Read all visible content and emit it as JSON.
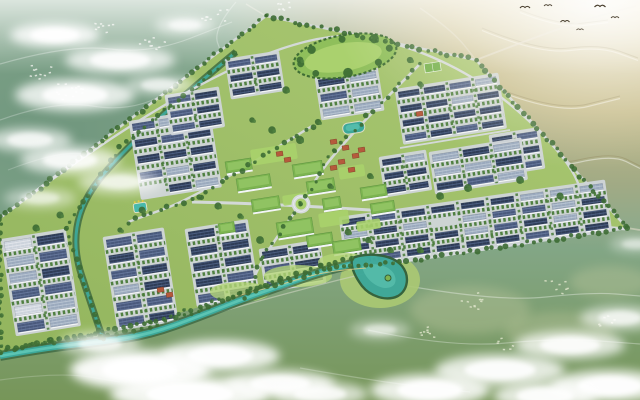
{
  "scene": {
    "canvas": {
      "w": 640,
      "h": 400
    },
    "palette": {
      "base": "#85a98e",
      "tealDeep": "#5f8770",
      "olive": "#74924f",
      "golden1": "#f2ecdb",
      "golden2": "#cdbf8e",
      "golden3": "#b7ab7d",
      "parkA": "#93b55e",
      "parkB": "#abc973",
      "lawn": "#a9d16c",
      "treeDark": "#3c6b33",
      "treeMid": "#4f8040",
      "road": "#d6dadd",
      "apron": "#d0d5d9",
      "wall": "#f4f6f8",
      "roofDark": "#2e3c56",
      "roofDarkLine": "#55698f",
      "roofMid": "#49597c",
      "roofMidLine": "#6e81a5",
      "roofLight": "#9aa9bd",
      "roofLightLine": "#c3cdd9",
      "roofPale": "#ccd3dc",
      "roofPaleLine": "#e9ecf1",
      "civicRoof": "#7cb450",
      "civicRoofIn": "#95c766",
      "civicEdge": "#5d9440",
      "villa": "#b55a3c",
      "villaEdge": "#7e3b24",
      "water": "#3da89a",
      "waterLight": "#62c9b7",
      "bank": "#33603c",
      "cloud": "#ffffff",
      "bird": "#473d2c",
      "village": "#e9ece6",
      "villageOlive": "#dde3c9",
      "ridge": "#8e8157",
      "pathGold": "#e6cf8a",
      "field": "#6fae46"
    },
    "park": {
      "boundary": [
        [
          0,
          218
        ],
        [
          266,
          16
        ],
        [
          476,
          60
        ],
        [
          627,
          228
        ],
        [
          400,
          262
        ],
        [
          330,
          268
        ],
        [
          248,
          292
        ],
        [
          150,
          322
        ],
        [
          60,
          340
        ],
        [
          0,
          352
        ]
      ]
    },
    "clusters": [
      {
        "name": "west-grid-a",
        "x": 4,
        "y": 242,
        "rot": -9,
        "rows": 6,
        "cols": 2,
        "bl": 27,
        "bw": 9,
        "gx": 6,
        "gy": 7.5,
        "mix": [
          0.5,
          0.25,
          0.15,
          0.1
        ]
      },
      {
        "name": "west-grid-b",
        "x": 106,
        "y": 240,
        "rot": -9,
        "rows": 6,
        "cols": 2,
        "bl": 25,
        "bw": 8,
        "gx": 6,
        "gy": 8,
        "mix": [
          0.6,
          0.3,
          0.1,
          0
        ]
      },
      {
        "name": "west-grid-c",
        "x": 188,
        "y": 232,
        "rot": -9,
        "rows": 5,
        "cols": 2,
        "bl": 26,
        "bw": 8,
        "gx": 6,
        "gy": 8,
        "mix": [
          0.65,
          0.25,
          0.1,
          0
        ]
      },
      {
        "name": "midwest-grid",
        "x": 132,
        "y": 124,
        "rot": -9,
        "rows": 5,
        "cols": 3,
        "bl": 22,
        "bw": 7,
        "gx": 5,
        "gy": 9.5,
        "mix": [
          0.6,
          0.25,
          0.15,
          0
        ]
      },
      {
        "name": "upperleft-row-a",
        "x": 168,
        "y": 98,
        "rot": -9,
        "rows": 3,
        "cols": 2,
        "bl": 22,
        "bw": 6,
        "gx": 5,
        "gy": 8,
        "mix": [
          0.7,
          0.3,
          0,
          0
        ]
      },
      {
        "name": "upperleft-row-b",
        "x": 228,
        "y": 62,
        "rot": -9,
        "rows": 3,
        "cols": 2,
        "bl": 22,
        "bw": 6,
        "gx": 5,
        "gy": 8,
        "mix": [
          0.7,
          0.3,
          0,
          0
        ]
      },
      {
        "name": "topmid-band",
        "x": 318,
        "y": 80,
        "rot": -9,
        "rows": 3,
        "cols": 2,
        "bl": 26,
        "bw": 7,
        "gx": 6,
        "gy": 8,
        "mix": [
          0.3,
          0.3,
          0.4,
          0
        ]
      },
      {
        "name": "righttop-grid",
        "x": 398,
        "y": 92,
        "rot": -9,
        "rows": 4,
        "cols": 4,
        "bl": 21,
        "bw": 6,
        "gx": 5,
        "gy": 8.5,
        "mix": [
          0.65,
          0.2,
          0.15,
          0
        ]
      },
      {
        "name": "righttop-east",
        "x": 492,
        "y": 138,
        "rot": -9,
        "rows": 3,
        "cols": 2,
        "bl": 20,
        "bw": 6,
        "gx": 5,
        "gy": 8.5,
        "mix": [
          0.7,
          0.3,
          0,
          0
        ]
      },
      {
        "name": "right-light-band",
        "x": 432,
        "y": 155,
        "rot": -9,
        "rows": 3,
        "cols": 3,
        "bl": 26,
        "bw": 7,
        "gx": 5,
        "gy": 7.5,
        "mix": [
          0.15,
          0.2,
          0.45,
          0.2
        ]
      },
      {
        "name": "east-of-center",
        "x": 382,
        "y": 160,
        "rot": -9,
        "rows": 3,
        "cols": 2,
        "bl": 19,
        "bw": 6,
        "gx": 4,
        "gy": 8,
        "mix": [
          0.7,
          0.2,
          0.1,
          0
        ]
      },
      {
        "name": "southeast-grid",
        "x": 342,
        "y": 220,
        "rot": -8,
        "rows": 4,
        "cols": 9,
        "bl": 23,
        "bw": 6,
        "gx": 7,
        "gy": 7,
        "mix": [
          0.6,
          0.25,
          0.15,
          0
        ]
      },
      {
        "name": "south-center",
        "x": 262,
        "y": 252,
        "rot": -9,
        "rows": 3,
        "cols": 2,
        "bl": 25,
        "bw": 7,
        "gx": 6,
        "gy": 8,
        "mix": [
          0.6,
          0.3,
          0.1,
          0
        ]
      }
    ],
    "civic": [
      [
        225,
        162,
        26,
        12
      ],
      [
        236,
        179,
        34,
        13
      ],
      [
        251,
        200,
        28,
        13
      ],
      [
        292,
        165,
        30,
        13
      ],
      [
        306,
        182,
        28,
        13
      ],
      [
        322,
        199,
        18,
        12
      ],
      [
        276,
        223,
        36,
        16
      ],
      [
        306,
        236,
        26,
        12
      ],
      [
        360,
        188,
        26,
        12
      ],
      [
        370,
        204,
        24,
        11
      ],
      [
        332,
        242,
        28,
        13
      ],
      [
        218,
        224,
        16,
        11
      ]
    ],
    "lawns": [
      [
        250,
        150,
        46,
        16
      ],
      [
        282,
        196,
        26,
        10
      ],
      [
        318,
        214,
        30,
        14
      ],
      [
        338,
        168,
        26,
        12
      ],
      [
        356,
        222,
        24,
        10
      ]
    ],
    "villas": [
      [
        276,
        152
      ],
      [
        284,
        158
      ],
      [
        330,
        140
      ],
      [
        342,
        146
      ],
      [
        352,
        154
      ],
      [
        338,
        160
      ],
      [
        358,
        148
      ],
      [
        330,
        166
      ],
      [
        348,
        168
      ],
      [
        416,
        112
      ],
      [
        157,
        288
      ],
      [
        166,
        293
      ]
    ],
    "lakes": {
      "villaLake": {
        "x": 342,
        "y": 124,
        "w": 22,
        "h": 11
      },
      "pool": {
        "x": 133,
        "y": 204,
        "w": 13,
        "h": 9
      }
    },
    "topPark": {
      "cx": 345,
      "cy": 56,
      "rx": 52,
      "ry": 21,
      "rot": -10
    },
    "sportsField": {
      "x": 424,
      "y": 64,
      "w": 16,
      "h": 9
    },
    "roundabout": {
      "cx": 301,
      "cy": 204,
      "r": 9.5
    },
    "roads": [
      {
        "pts": [
          [
            192,
            202
          ],
          [
            298,
            204
          ],
          [
            627,
            229
          ]
        ],
        "w": 3
      },
      {
        "pts": [
          [
            420,
            64
          ],
          [
            334,
            150
          ],
          [
            301,
            204
          ],
          [
            262,
            258
          ],
          [
            246,
            298
          ]
        ],
        "w": 2.6
      },
      {
        "pts": [
          [
            312,
            126
          ],
          [
            200,
            196
          ],
          [
            128,
            222
          ]
        ],
        "w": 2.4
      },
      {
        "pts": [
          [
            400,
            148
          ],
          [
            510,
            130
          ]
        ],
        "w": 1.8
      },
      {
        "pts": [
          [
            0,
            218
          ],
          [
            266,
            16
          ],
          [
            476,
            60
          ],
          [
            627,
            228
          ],
          [
            400,
            262
          ]
        ],
        "w": 2.4
      }
    ],
    "extRoads": [
      {
        "pts": [
          [
            476,
            60
          ],
          [
            538,
            36
          ],
          [
            598,
            16
          ],
          [
            636,
            6
          ]
        ],
        "w": 1.8,
        "op": 0.7
      },
      {
        "pts": [
          [
            420,
            8
          ],
          [
            452,
            30
          ],
          [
            476,
            60
          ]
        ],
        "w": 1.4,
        "op": 0.5
      },
      {
        "pts": [
          [
            627,
            228
          ],
          [
            640,
            230
          ]
        ],
        "w": 1.8,
        "op": 0.6
      },
      {
        "pts": [
          [
            266,
            16
          ],
          [
            246,
            4
          ]
        ],
        "w": 1.4,
        "op": 0.5
      }
    ],
    "canals": [
      {
        "pts": [
          [
            236,
            52
          ],
          [
            120,
            148
          ],
          [
            66,
            228
          ],
          [
            97,
            322
          ],
          [
            103,
            338
          ]
        ]
      }
    ],
    "river": {
      "pts": [
        [
          0,
          356
        ],
        [
          50,
          347
        ],
        [
          100,
          342
        ],
        [
          150,
          334
        ],
        [
          200,
          316
        ],
        [
          240,
          300
        ],
        [
          280,
          286
        ],
        [
          320,
          272
        ],
        [
          352,
          264
        ]
      ],
      "pond": "M352,258 C368,252 392,254 402,266 C410,276 408,290 398,296 C386,302 370,296 362,286 C356,278 350,268 352,258 Z",
      "island": [
        388,
        278
      ]
    },
    "riversideStrips": [
      [
        240,
        292,
        30,
        10
      ],
      [
        298,
        276,
        34,
        11
      ],
      [
        344,
        262,
        26,
        9
      ]
    ],
    "riverPath": {
      "pts": [
        [
          228,
          298
        ],
        [
          270,
          288
        ],
        [
          322,
          272
        ],
        [
          366,
          268
        ]
      ]
    },
    "southRoad": {
      "pts": [
        [
          150,
          332
        ],
        [
          240,
          306
        ],
        [
          330,
          282
        ],
        [
          372,
          272
        ]
      ]
    },
    "villages": [
      {
        "x": 72,
        "y": 92,
        "n": 14,
        "s": 16,
        "tone": "village"
      },
      {
        "x": 40,
        "y": 72,
        "n": 10,
        "s": 12,
        "tone": "village"
      },
      {
        "x": 150,
        "y": 40,
        "n": 10,
        "s": 14,
        "tone": "village"
      },
      {
        "x": 214,
        "y": 14,
        "n": 9,
        "s": 13,
        "tone": "village"
      },
      {
        "x": 104,
        "y": 26,
        "n": 8,
        "s": 10,
        "tone": "village"
      },
      {
        "x": 286,
        "y": 6,
        "n": 7,
        "s": 12,
        "tone": "village"
      },
      {
        "x": 470,
        "y": 300,
        "n": 10,
        "s": 14,
        "tone": "villageOlive"
      },
      {
        "x": 556,
        "y": 286,
        "n": 8,
        "s": 12,
        "tone": "villageOlive"
      },
      {
        "x": 428,
        "y": 332,
        "n": 8,
        "s": 12,
        "tone": "villageOlive"
      },
      {
        "x": 606,
        "y": 320,
        "n": 6,
        "s": 10,
        "tone": "villageOlive"
      },
      {
        "x": 508,
        "y": 344,
        "n": 6,
        "s": 12,
        "tone": "villageOlive"
      }
    ],
    "countrysidePaths": [
      {
        "pts": [
          [
            0,
            64
          ],
          [
            70,
            44
          ],
          [
            150,
            54
          ],
          [
            232,
            22
          ]
        ],
        "op": 0.3
      },
      {
        "pts": [
          [
            0,
            120
          ],
          [
            56,
            100
          ],
          [
            128,
            112
          ],
          [
            186,
            84
          ],
          [
            240,
            56
          ]
        ],
        "op": 0.25
      },
      {
        "pts": [
          [
            8,
            170
          ],
          [
            60,
            150
          ],
          [
            104,
            158
          ]
        ],
        "op": 0.2
      },
      {
        "pts": [
          [
            236,
            2
          ],
          [
            212,
            30
          ],
          [
            224,
            58
          ],
          [
            206,
            88
          ]
        ],
        "op": 0.3
      },
      {
        "pts": [
          [
            408,
            286
          ],
          [
            500,
            302
          ],
          [
            592,
            292
          ],
          [
            640,
            296
          ]
        ],
        "op": 0.35
      },
      {
        "pts": [
          [
            368,
            330
          ],
          [
            452,
            348
          ],
          [
            560,
            338
          ],
          [
            640,
            344
          ]
        ],
        "op": 0.3
      },
      {
        "pts": [
          [
            300,
            368
          ],
          [
            380,
            382
          ],
          [
            470,
            392
          ]
        ],
        "op": 0.25
      },
      {
        "pts": [
          [
            0,
            380
          ],
          [
            60,
            372
          ],
          [
            120,
            382
          ]
        ],
        "op": 0.2
      }
    ],
    "ridges": [
      {
        "pts": [
          [
            482,
            28
          ],
          [
            540,
            52
          ],
          [
            600,
            44
          ],
          [
            638,
            58
          ]
        ]
      },
      {
        "pts": [
          [
            492,
            86
          ],
          [
            556,
            112
          ],
          [
            620,
            96
          ]
        ]
      },
      {
        "pts": [
          [
            470,
            140
          ],
          [
            544,
            168
          ],
          [
            612,
            152
          ],
          [
            640,
            166
          ]
        ]
      },
      {
        "pts": [
          [
            520,
            10
          ],
          [
            560,
            26
          ],
          [
            608,
            20
          ]
        ]
      }
    ],
    "birds": [
      [
        525,
        8,
        1
      ],
      [
        548,
        6,
        0.8
      ],
      [
        600,
        7,
        1.1
      ],
      [
        565,
        22,
        0.9
      ],
      [
        580,
        30,
        0.7
      ],
      [
        615,
        18,
        0.8
      ]
    ],
    "treeClumps": [
      [
        318,
        122
      ],
      [
        300,
        140
      ],
      [
        370,
        176
      ],
      [
        330,
        186
      ],
      [
        240,
        216
      ],
      [
        218,
        206
      ],
      [
        260,
        240
      ],
      [
        348,
        232
      ],
      [
        368,
        240
      ],
      [
        142,
        210
      ],
      [
        120,
        230
      ],
      [
        60,
        215
      ],
      [
        36,
        228
      ],
      [
        440,
        196
      ],
      [
        468,
        188
      ],
      [
        520,
        180
      ],
      [
        560,
        196
      ],
      [
        420,
        84
      ],
      [
        300,
        60
      ],
      [
        286,
        90
      ],
      [
        410,
        60
      ],
      [
        252,
        120
      ],
      [
        272,
        130
      ],
      [
        390,
        250
      ],
      [
        420,
        250
      ]
    ],
    "clouds": [
      [
        55,
        35,
        45,
        12,
        0.85
      ],
      [
        120,
        60,
        55,
        14,
        0.75
      ],
      [
        75,
        95,
        60,
        16,
        0.8
      ],
      [
        30,
        140,
        42,
        12,
        0.65
      ],
      [
        160,
        85,
        35,
        10,
        0.55
      ],
      [
        185,
        25,
        30,
        9,
        0.6
      ],
      [
        70,
        160,
        50,
        14,
        0.7
      ],
      [
        120,
        182,
        42,
        12,
        0.55
      ],
      [
        40,
        198,
        36,
        10,
        0.45
      ],
      [
        140,
        370,
        70,
        20,
        0.95
      ],
      [
        220,
        356,
        60,
        16,
        0.85
      ],
      [
        190,
        394,
        80,
        18,
        0.9
      ],
      [
        280,
        384,
        55,
        14,
        0.8
      ],
      [
        100,
        344,
        40,
        12,
        0.6
      ],
      [
        320,
        394,
        48,
        12,
        0.7
      ],
      [
        430,
        390,
        60,
        16,
        0.85
      ],
      [
        500,
        370,
        65,
        16,
        0.8
      ],
      [
        570,
        345,
        55,
        14,
        0.75
      ],
      [
        620,
        318,
        40,
        12,
        0.6
      ],
      [
        610,
        386,
        60,
        16,
        0.85
      ],
      [
        545,
        396,
        52,
        14,
        0.8
      ],
      [
        380,
        330,
        30,
        9,
        0.45
      ],
      [
        636,
        244,
        26,
        8,
        0.4
      ]
    ]
  }
}
